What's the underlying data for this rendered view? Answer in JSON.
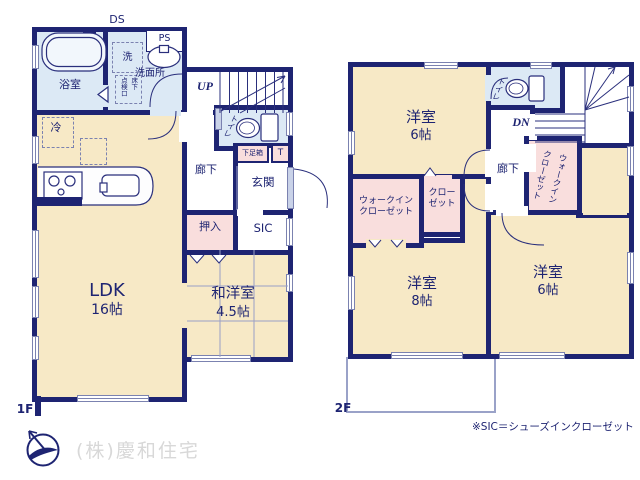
{
  "f1": {
    "label": "1F",
    "ldk": "LDK",
    "ldk_size": "16帖",
    "wayo": "和洋室",
    "wayo_size": "4.5帖",
    "bath": "浴室",
    "washroom": "洗面所",
    "washer": "洗",
    "ps": "PS",
    "ds": "DS",
    "hatch_col1": "床下",
    "hatch_col2": "点検口",
    "fridge": "冷",
    "up": "UP",
    "toilet": "トイレ",
    "shoebox": "下足箱",
    "t": "T",
    "hall": "廊下",
    "genkan": "玄関",
    "oshiire": "押入",
    "sic": "SIC"
  },
  "f2": {
    "label": "2F",
    "bed1": "洋室",
    "bed1_size": "6帖",
    "bed2": "洋室",
    "bed2_size": "8帖",
    "bed3": "洋室",
    "bed3_size": "6帖",
    "toilet": "トイレ",
    "dn": "DN",
    "hall": "廊下",
    "wic_line1": "ウォークイン",
    "wic_line2": "クローゼット",
    "closet_line1": "クロー",
    "closet_line2": "ゼット"
  },
  "footer": {
    "note": "※SIC＝シューズインクローゼット",
    "company": "(株)慶和住宅"
  },
  "colors": {
    "wall": "#1e2472",
    "room_cream": "#f7e9c6",
    "wet_blue": "#dce9f5",
    "closet_pink": "#f9dedd",
    "thin_line": "#7b82b0",
    "text": "#1e2472",
    "watermark": "#d8d8d8"
  }
}
